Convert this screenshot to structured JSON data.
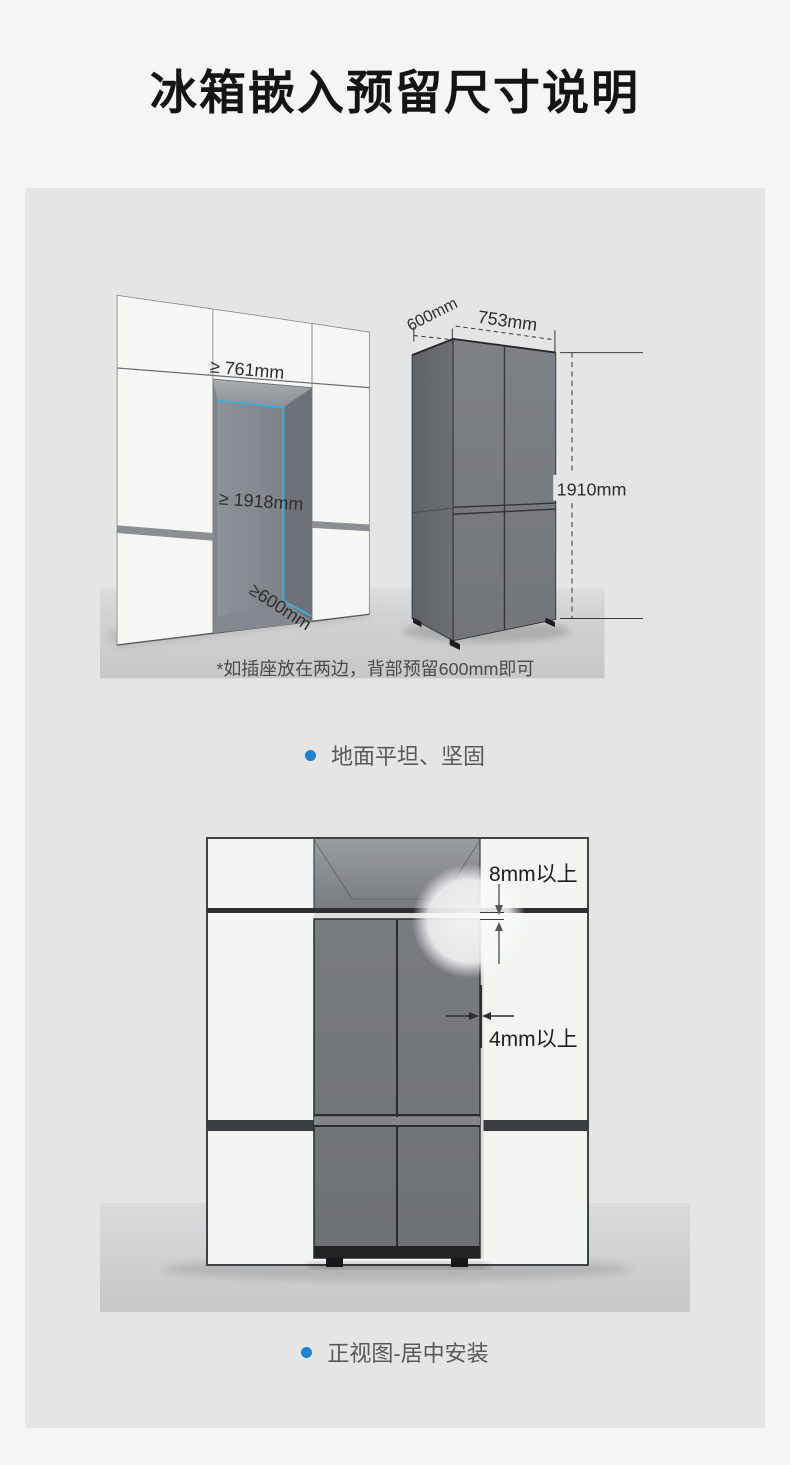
{
  "title": "冰箱嵌入预留尺寸说明",
  "colors": {
    "page_bg": "#f5f5f6",
    "panel_bg": "#e5e5e6",
    "accent_blue": "#1a82d4",
    "highlight_cyan": "#36b3e3"
  },
  "top_scene": {
    "labels": {
      "niche_width": "≥ 761mm",
      "niche_height": "≥ 1918mm",
      "niche_depth": "≥600mm",
      "fridge_depth": "600mm",
      "fridge_width": "753mm",
      "fridge_height": "1910mm"
    },
    "footnote": "*如插座放在两边，背部预留600mm即可",
    "caption": "地面平坦、坚固"
  },
  "bottom_scene": {
    "labels": {
      "top_gap": "8mm以上",
      "side_gap": "4mm以上"
    },
    "caption": "正视图-居中安装"
  }
}
